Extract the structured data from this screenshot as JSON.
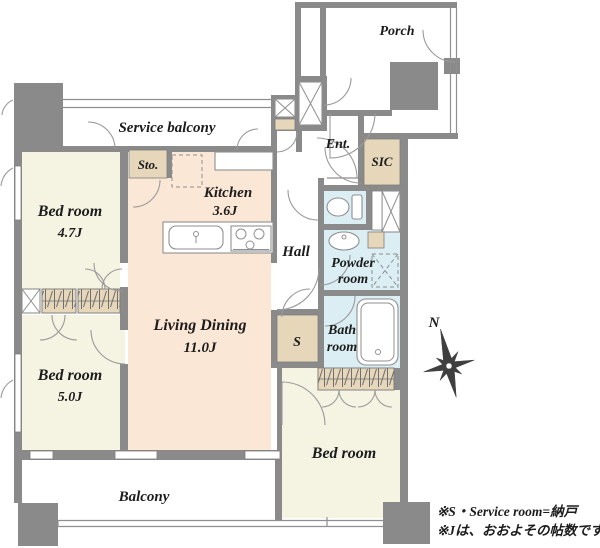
{
  "plan": {
    "rooms": {
      "porch": "Porch",
      "service_balcony": "Service balcony",
      "sto": "Sto.",
      "kitchen": "Kitchen",
      "kitchen_size": "3.6J",
      "ent": "Ent.",
      "sic": "SIC",
      "bedroom_47": "Bed room",
      "bedroom_47_size": "4.7J",
      "hall": "Hall",
      "living_dining": "Living Dining",
      "living_dining_size": "11.0J",
      "powder_room_line1": "Powder",
      "powder_room_line2": "room",
      "service_room": "S",
      "bath_room_line1": "Bath",
      "bath_room_line2": "room",
      "bedroom_50": "Bed room",
      "bedroom_50_size": "5.0J",
      "bedroom_main": "Bed room",
      "balcony": "Balcony"
    },
    "compass": {
      "north_label": "N"
    },
    "notes": {
      "line1": "※S・Service room=納戸",
      "line2": "※Jは、おおよその帖数です"
    },
    "colors": {
      "wall": "#8a8a8a",
      "bedroom_fill": "#f5f3e2",
      "living_fill": "#fbe7d6",
      "wet_fill": "#daeef3",
      "closet_fill": "#e6d7ba",
      "text": "#1c1c1c"
    }
  }
}
